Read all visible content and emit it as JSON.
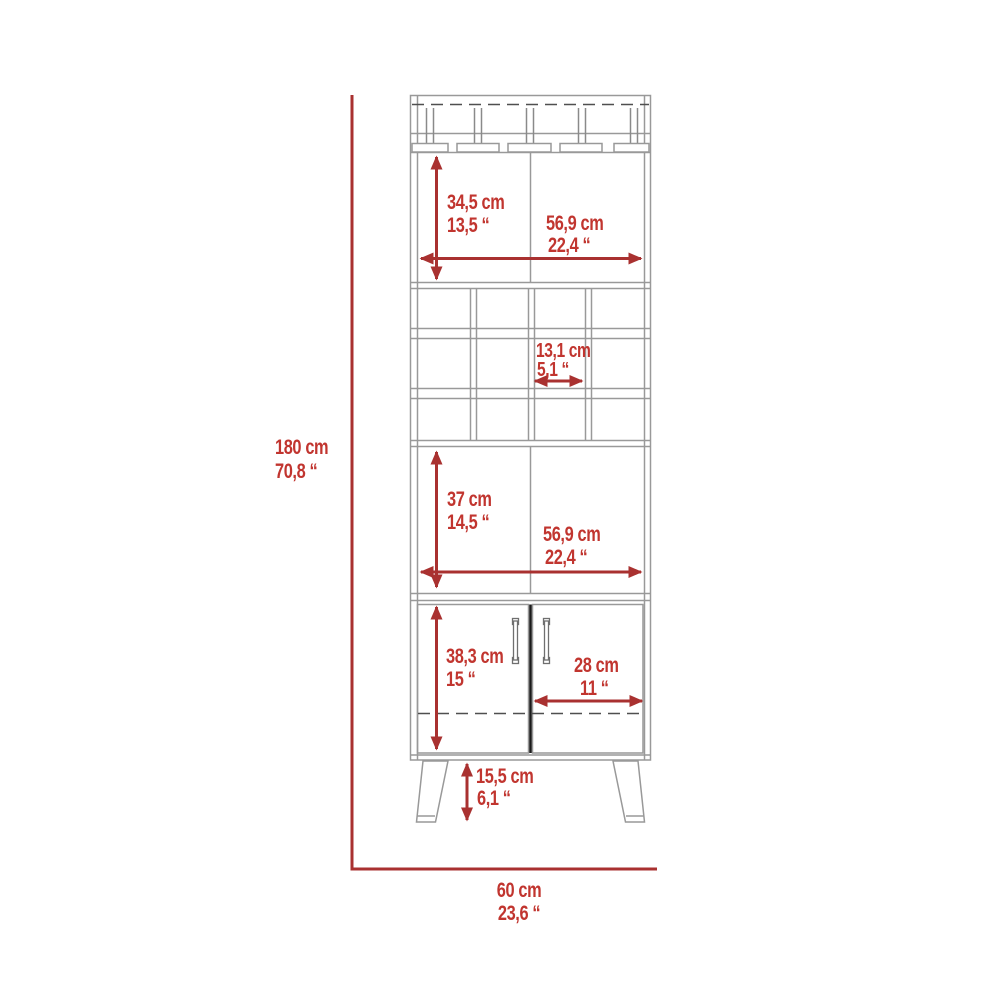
{
  "figure": {
    "name": "bar-cabinet-dimension-diagram",
    "units_note": "cm and inches"
  },
  "colors": {
    "dimension_line_red": "#a93130",
    "dimension_text_red": "#c1352f",
    "cabinet_line_gray": "#999999",
    "dashed_line_gray": "#4f4f4f",
    "door_divider_dark": "#1b1b1b",
    "background": "#ffffff"
  },
  "dimensions": {
    "overall_height": {
      "cm": "180 cm",
      "inches": "70,8 “"
    },
    "overall_width": {
      "cm": "60 cm",
      "inches": "23,6 “"
    },
    "top_shelf_height": {
      "cm": "34,5 cm",
      "inches": "13,5 “"
    },
    "top_shelf_width": {
      "cm": "56,9 cm",
      "inches": "22,4 “"
    },
    "wine_cubby_width": {
      "cm": "13,1 cm",
      "inches": "5,1 “"
    },
    "middle_shelf_height": {
      "cm": "37 cm",
      "inches": "14,5 “"
    },
    "middle_shelf_width": {
      "cm": "56,9 cm",
      "inches": "22,4 “"
    },
    "door_section_height": {
      "cm": "38,3 cm",
      "inches": "15 “"
    },
    "door_width": {
      "cm": "28 cm",
      "inches": "11 “"
    },
    "leg_height": {
      "cm": "15,5 cm",
      "inches": "6,1 “"
    }
  }
}
